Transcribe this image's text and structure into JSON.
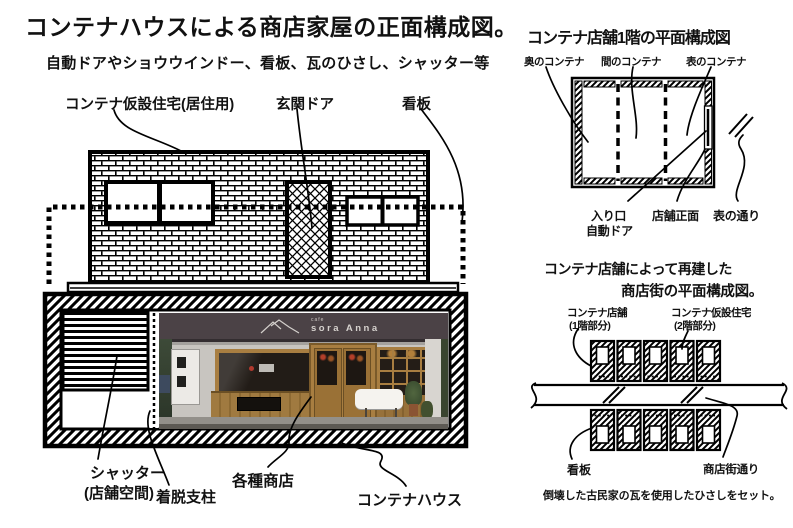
{
  "page": {
    "title": "コンテナハウスによる商店家屋の正面構成図。",
    "subtitle": "自動ドアやショウウインドー、看板、瓦のひさし、シャッター等"
  },
  "front_elevation": {
    "labels": {
      "container_housing": "コンテナ仮設住宅(居住用)",
      "entrance_door": "玄関ドア",
      "signboard": "看板",
      "shutter_line1": "シャッター",
      "shutter_line2": "(店舗空間)",
      "removable_post": "着脱支柱",
      "various_shops": "各種商店",
      "container_house": "コンテナハウス"
    },
    "photo_sign": {
      "small": "cafe",
      "name": "sora Anna"
    }
  },
  "floor_plan": {
    "title": "コンテナ店舗1階の平面構成図",
    "labels": {
      "back_container": "奥のコンテナ",
      "middle_container": "間のコンテナ",
      "front_container": "表のコンテナ",
      "entrance_line1": "入り口",
      "entrance_line2": "自動ドア",
      "shop_front": "店舗正面",
      "front_street": "表の通り"
    }
  },
  "street_plan": {
    "title_line1": "コンテナ店舗によって再建した",
    "title_line2": "商店街の平面構成図。",
    "labels": {
      "shop_line1": "コンテナ店舗",
      "shop_line2": "(1階部分)",
      "housing_line1": "コンテナ仮設住宅",
      "housing_line2": "(2階部分)",
      "sign": "看板",
      "street": "商店街通り"
    },
    "note": "倒壊した古民家の瓦を使用したひさしをセット。"
  },
  "colors": {
    "line": "#000000",
    "awning": "#4b4246",
    "wood": "#a87e41",
    "photo_wall": "#c8c5c0",
    "foliage": "#3d4a38",
    "table": "#f5f3ef"
  }
}
